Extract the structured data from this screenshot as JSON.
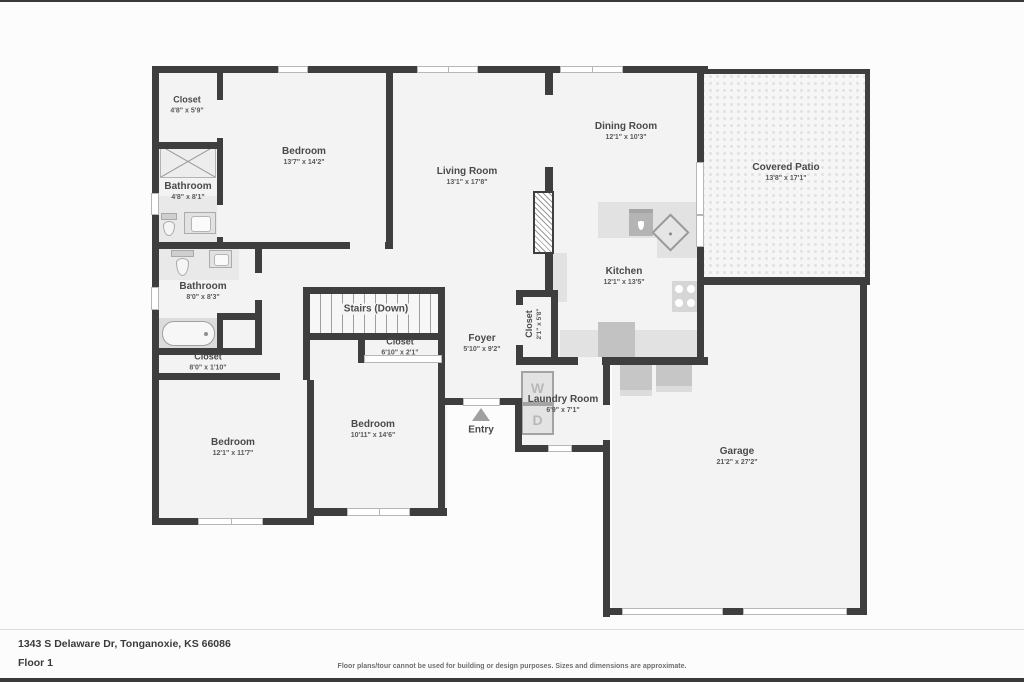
{
  "rooms": {
    "closet_tl": {
      "name": "Closet",
      "dims": "4'8\" x 5'9\""
    },
    "bedroom_tl": {
      "name": "Bedroom",
      "dims": "13'7\" x 14'2\""
    },
    "bathroom_1": {
      "name": "Bathroom",
      "dims": "4'8\" x 8'1\""
    },
    "bathroom_2": {
      "name": "Bathroom",
      "dims": "8'0\" x 8'3\""
    },
    "closet_hall": {
      "name": "Closet",
      "dims": "8'0\" x 1'10\""
    },
    "living": {
      "name": "Living Room",
      "dims": "13'1\" x 17'8\""
    },
    "dining": {
      "name": "Dining Room",
      "dims": "12'1\" x 10'3\""
    },
    "patio": {
      "name": "Covered Patio",
      "dims": "13'8\" x 17'1\""
    },
    "kitchen": {
      "name": "Kitchen",
      "dims": "12'1\" x 13'5\""
    },
    "stairs": {
      "name": "Stairs (Down)"
    },
    "closet_bed2": {
      "name": "Closet",
      "dims": "6'10\" x 2'1\""
    },
    "foyer": {
      "name": "Foyer",
      "dims": "5'10\" x 9'2\""
    },
    "closet_entry": {
      "name": "Closet",
      "dims": "2'1\" x 5'8\""
    },
    "laundry": {
      "name": "Laundry Room",
      "dims": "6'9\" x 7'1\""
    },
    "entry": {
      "name": "Entry"
    },
    "bedroom_mid": {
      "name": "Bedroom",
      "dims": "10'11\" x 14'6\""
    },
    "bedroom_bl": {
      "name": "Bedroom",
      "dims": "12'1\" x 11'7\""
    },
    "garage": {
      "name": "Garage",
      "dims": "21'2\" x 27'2\""
    }
  },
  "appliances": {
    "washer": "W",
    "dryer": "D"
  },
  "footer": {
    "address": "1343 S Delaware Dr, Tonganoxie, KS 66086",
    "floor": "Floor 1",
    "disclaimer": "Floor plans/tour cannot be used for building or design purposes. Sizes and dimensions are approximate."
  },
  "colors": {
    "wall": "#3e3e3e",
    "room_fill": "#f3f3f3",
    "counter": "#e2e2e2",
    "fixture": "#c6c6c6",
    "label_text": "#4a4a4a"
  }
}
